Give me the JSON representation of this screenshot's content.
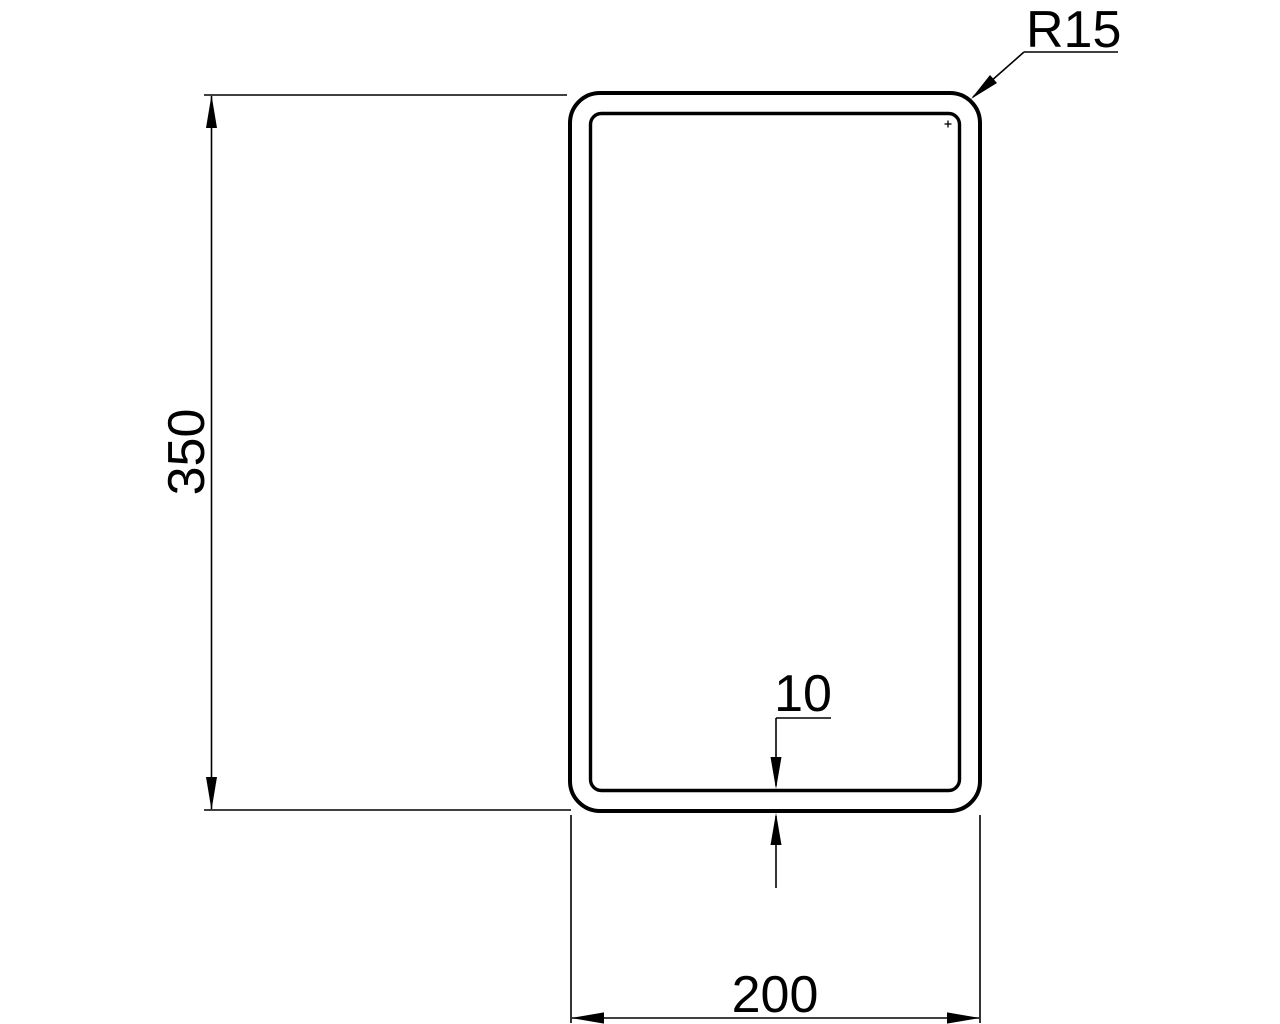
{
  "drawing": {
    "kind": "technical-cross-section",
    "description": "Rectangular hollow section profile with dimensions",
    "dimensions": {
      "height_label": "350",
      "width_label": "200",
      "wall_thickness_label": "10",
      "corner_radius_label": "R15"
    },
    "colors": {
      "line": "#000000",
      "background": "#ffffff"
    }
  }
}
